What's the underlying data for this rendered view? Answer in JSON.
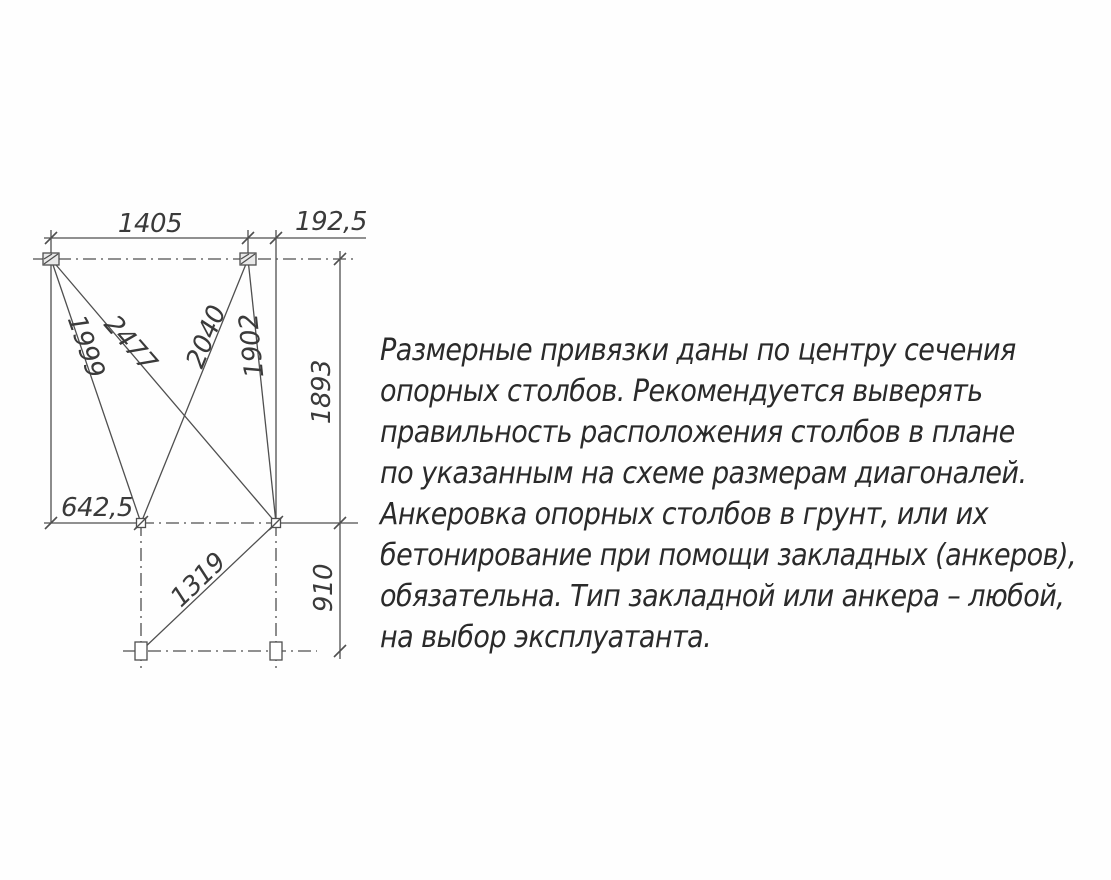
{
  "diagram": {
    "dimensions": {
      "top_width": "1405",
      "top_offset": "192,5",
      "height_upper": "1893",
      "mid_offset": "642,5",
      "height_lower": "910",
      "diag_tl_ml": "1999",
      "diag_tl_mr": "2477",
      "diag_tr_ml": "2040",
      "diag_tr_mr": "1902",
      "diag_mr_bl": "1319"
    }
  },
  "notes": {
    "lines": [
      "Размерные привязки даны по центру сечения",
      "опорных столбов. Рекомендуется выверять",
      "правильность расположения столбов в плане",
      "по указанным на схеме размерам диагоналей.",
      "Анкеровка опорных столбов в грунт, или их",
      "бетонирование при помощи закладных (анкеров),",
      "обязательна. Тип закладной или анкера – любой,",
      "на выбор эксплуатанта."
    ]
  },
  "colors": {
    "line": "#4f4f4f",
    "dim_text": "#3a3a3a",
    "note_text": "#2a2a2a",
    "background": "#ffffff"
  }
}
